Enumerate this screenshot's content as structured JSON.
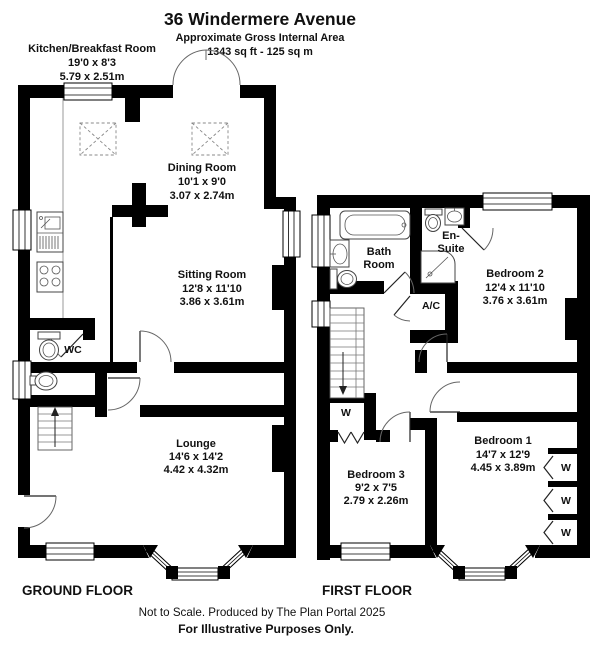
{
  "header": {
    "title": "36 Windermere Avenue",
    "subtitle": "Approximate Gross Internal Area",
    "area": "1343 sq ft - 125 sq m"
  },
  "ground_floor": {
    "label": "GROUND FLOOR",
    "kitchen": {
      "name": "Kitchen/Breakfast Room",
      "imperial": "19'0 x 8'3",
      "metric": "5.79 x 2.51m"
    },
    "dining": {
      "name": "Dining Room",
      "imperial": "10'1 x 9'0",
      "metric": "3.07 x 2.74m"
    },
    "sitting": {
      "name": "Sitting Room",
      "imperial": "12'8 x 11'10",
      "metric": "3.86 x 3.61m"
    },
    "wc": {
      "name": "WC"
    },
    "lounge": {
      "name": "Lounge",
      "imperial": "14'6 x 14'2",
      "metric": "4.42 x 4.32m"
    }
  },
  "first_floor": {
    "label": "FIRST FLOOR",
    "bathroom": {
      "line1": "Bath",
      "line2": "Room"
    },
    "ensuite": {
      "line1": "En-",
      "line2": "Suite"
    },
    "airing_cupboard": {
      "name": "A/C"
    },
    "bedroom1": {
      "name": "Bedroom 1",
      "imperial": "14'7 x 12'9",
      "metric": "4.45 x 3.89m"
    },
    "bedroom2": {
      "name": "Bedroom 2",
      "imperial": "12'4 x 11'10",
      "metric": "3.76 x 3.61m"
    },
    "bedroom3": {
      "name": "Bedroom 3",
      "imperial": "9'2 x 7'5",
      "metric": "2.79 x 2.26m"
    },
    "wardrobe_label": "W"
  },
  "footer": {
    "line1": "Not to Scale. Produced by The Plan Portal 2025",
    "line2": "For Illustrative Purposes Only."
  },
  "colors": {
    "wall": "#000000",
    "background": "#ffffff",
    "text": "#111111"
  }
}
